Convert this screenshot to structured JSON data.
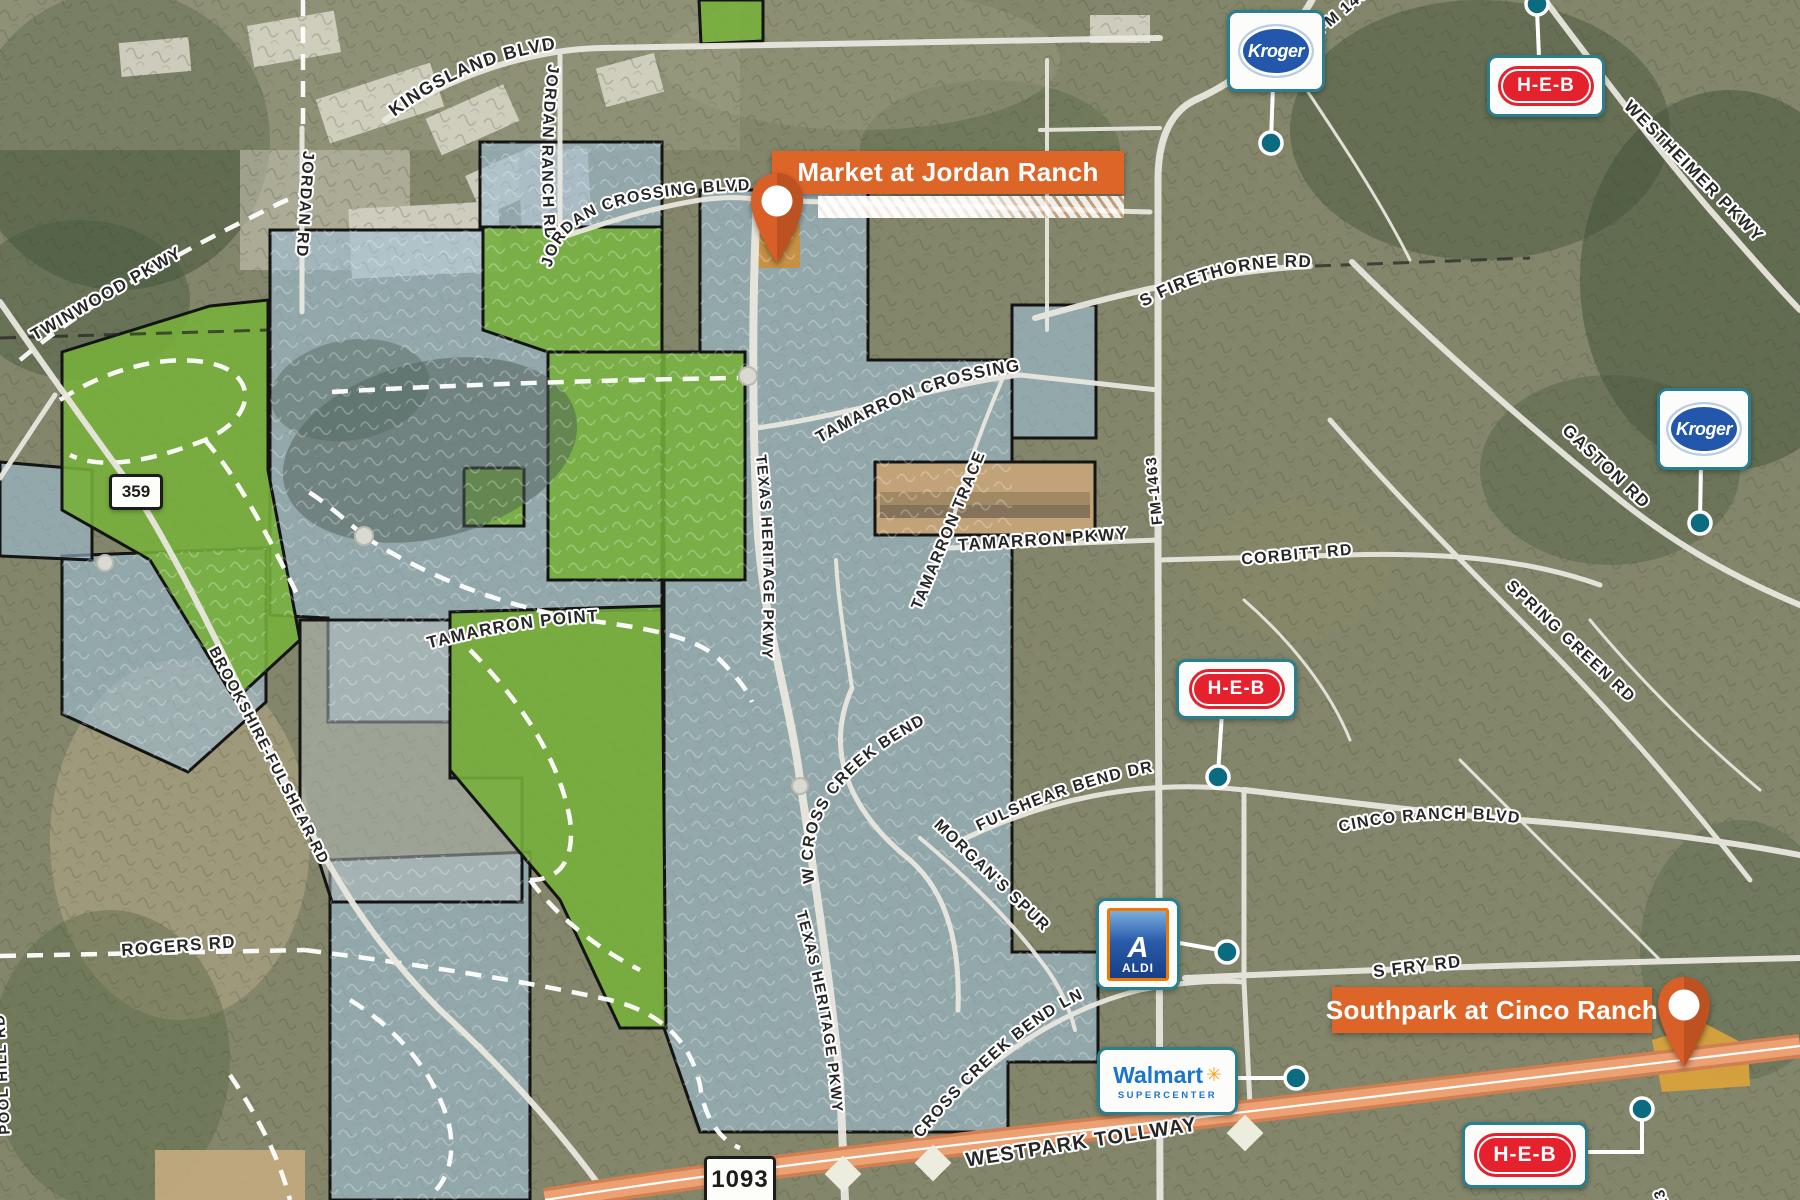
{
  "map": {
    "title": "Retail trade area map",
    "colors": {
      "banner_orange": "#DD6527",
      "connector_teal": "#0B6B80",
      "logo_border_teal": "#2A7F8E",
      "kroger_blue": "#2257AB",
      "heb_red": "#E5212E",
      "aldi_blue": "#1D4F9E",
      "aldi_orange": "#F07800",
      "walmart_blue": "#1A75CF",
      "walmart_yellow": "#F9A51A",
      "tollway_orange": "#E89A6B"
    },
    "banners": {
      "market": "Market at Jordan Ranch",
      "southpark": "Southpark at Cinco Ranch"
    },
    "shields": {
      "s359": "359",
      "s1093": "1093"
    },
    "retailers": {
      "kroger": "Kroger",
      "heb": "H-E-B",
      "aldi_a": "A",
      "aldi": "ALDI",
      "walmart": "Walmart",
      "walmart_spark": "✳",
      "walmart_sub": "SUPERCENTER"
    },
    "roads": {
      "kingsland": "KINGSLAND BLVD",
      "jordan_rd": "JORDAN RD",
      "jordan_ranch_rd": "JORDAN RANCH RD",
      "jordan_crossing": "JORDAN CROSSING BLVD",
      "twinwood": "TWINWOOD PKWY",
      "s_firethorne": "S FIRETHORNE RD",
      "westheimer": "WESTHEIMER PKWY",
      "fm_top": "FM 1463",
      "tamarron_crossing": "TAMARRON CROSSING",
      "tamarron_trace": "TAMARRON TRACE",
      "tamarron_pkwy": "TAMARRON PKWY",
      "fm_1463": "FM-1463",
      "corbitt": "CORBITT RD",
      "gaston": "GASTON RD",
      "spring_green": "SPRING GREEN RD",
      "cinco_ranch": "CINCO RANCH BLVD",
      "texas_heritage": "TEXAS HERITAGE PKWY",
      "tamarron_point": "TAMARRON POINT",
      "brookshire": "BROOKSHIRE-FULSHEAR RD",
      "w_cross_creek": "W CROSS CREEK BEND",
      "fulshear_bend": "FULSHEAR BEND DR",
      "morgans_spur": "MORGAN'S SPUR",
      "cross_creek_ln": "CROSS CREEK BEND LN",
      "s_fry": "S FRY RD",
      "rogers": "ROGERS RD",
      "westpark": "WESTPARK TOLLWAY",
      "pool_hill": "POOL HILL RD",
      "fm723": "723"
    }
  }
}
